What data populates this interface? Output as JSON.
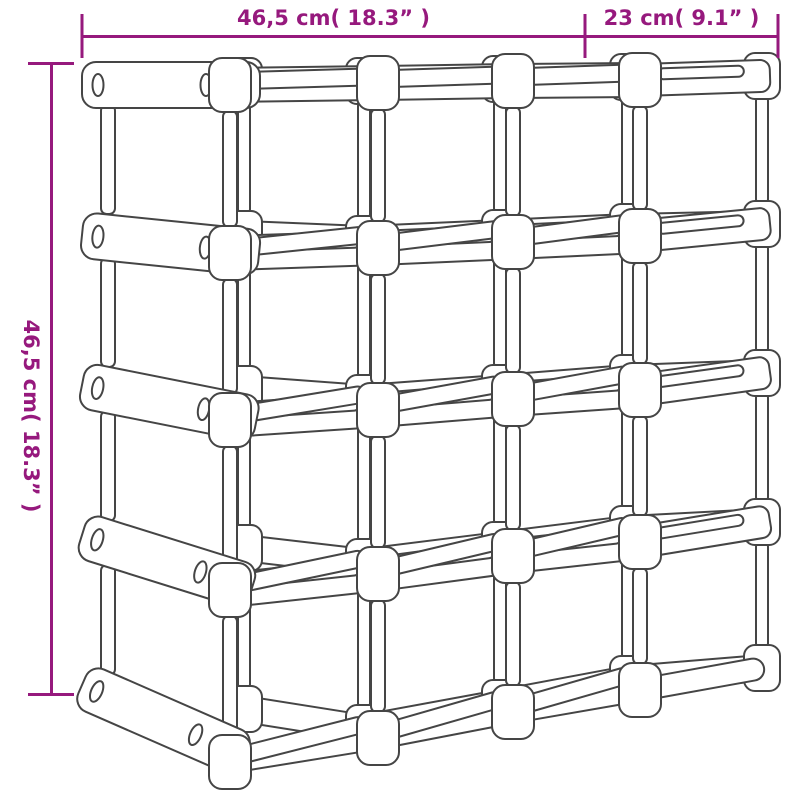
{
  "figure": {
    "title": "wine-rack-dimension-diagram"
  },
  "dimensions": {
    "width": "46,5 cm( 18.3” )",
    "depth": "23 cm( 9.1” )",
    "height": "46,5 cm( 18.3” )"
  },
  "colors": {
    "accent": "#96197D",
    "line": "#454545",
    "background": "#FFFFFF"
  }
}
